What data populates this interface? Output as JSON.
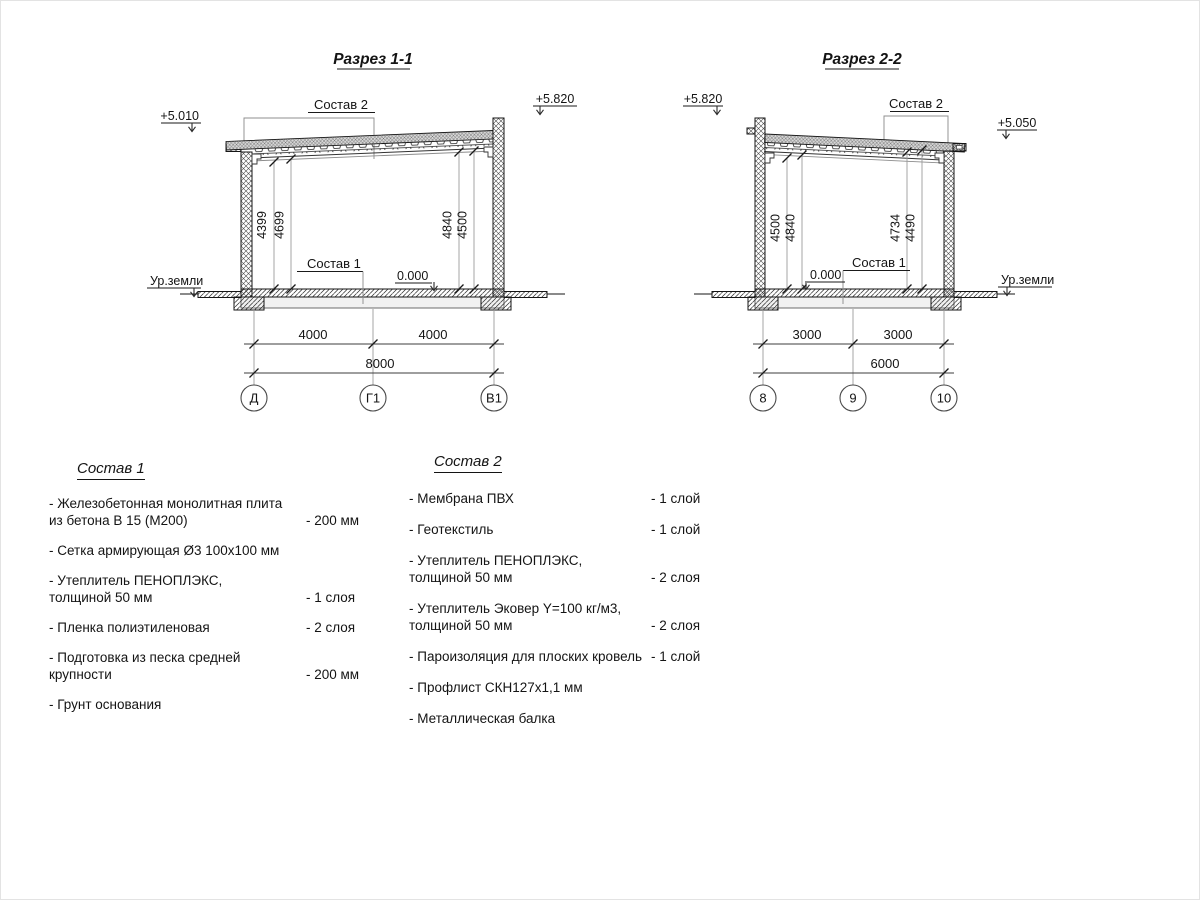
{
  "drawing": {
    "s1": {
      "title": "Разрез 1-1",
      "elev_left": "+5.010",
      "elev_right": "+5.820",
      "ground": "Ур.земли",
      "sostav2": "Состав 2",
      "sostav1": "Состав 1",
      "zero": "0.000",
      "dims_left": [
        "4399",
        "4699"
      ],
      "dims_right": [
        "4840",
        "4500"
      ],
      "spans": [
        "4000",
        "4000"
      ],
      "total": "8000",
      "axes": [
        "Д",
        "Г1",
        "В1"
      ]
    },
    "s2": {
      "title": "Разрез 2-2",
      "elev_left": "+5.820",
      "elev_right": "+5.050",
      "ground": "Ур.земли",
      "sostav2": "Состав 2",
      "sostav1": "Состав 1",
      "zero": "0.000",
      "dims_left": [
        "4500",
        "4840"
      ],
      "dims_right": [
        "4734",
        "4490"
      ],
      "spans": [
        "3000",
        "3000"
      ],
      "total": "6000",
      "axes": [
        "8",
        "9",
        "10"
      ]
    }
  },
  "comp1": {
    "title": "Состав 1",
    "items": [
      {
        "line1": "- Железобетонная  монолитная плита",
        "line2": "из бетона В 15 (М200)",
        "value": "- 200 мм"
      },
      {
        "line1": "- Сетка армирующая Ø3 100х100 мм",
        "line2": "",
        "value": ""
      },
      {
        "line1": "-  Утеплитель ПЕНОПЛЭКС,",
        "line2": "толщиной 50 мм",
        "value": "- 1 слоя"
      },
      {
        "line1": "- Пленка полиэтиленовая",
        "line2": "",
        "value": "-  2 слоя"
      },
      {
        "line1": "- Подготовка из песка средней",
        "line2": "крупности",
        "value": "- 200 мм"
      },
      {
        "line1": "- Грунт основания",
        "line2": "",
        "value": ""
      }
    ]
  },
  "comp2": {
    "title": "Состав 2",
    "items": [
      {
        "line1": "- Мембрана ПВХ",
        "line2": "",
        "value": "- 1 слой"
      },
      {
        "line1": "- Геотекстиль",
        "line2": "",
        "value": "- 1 слой"
      },
      {
        "line1": "- Утеплитель ПЕНОПЛЭКС,",
        "line2": "толщиной 50 мм",
        "value": "- 2 слоя"
      },
      {
        "line1": "- Утеплитель Эковер Y=100 кг/м3,",
        "line2": "толщиной 50 мм",
        "value": "- 2 слоя"
      },
      {
        "line1": "- Пароизоляция для плоских кровель",
        "line2": "",
        "value": "- 1 слой"
      },
      {
        "line1": "- Профлист СКН127х1,1 мм",
        "line2": "",
        "value": ""
      },
      {
        "line1": "- Металлическая балка",
        "line2": "",
        "value": ""
      }
    ]
  },
  "colors": {
    "line": "#1a1a1a",
    "dim_aux": "#9b9b9b",
    "background": "#ffffff"
  }
}
